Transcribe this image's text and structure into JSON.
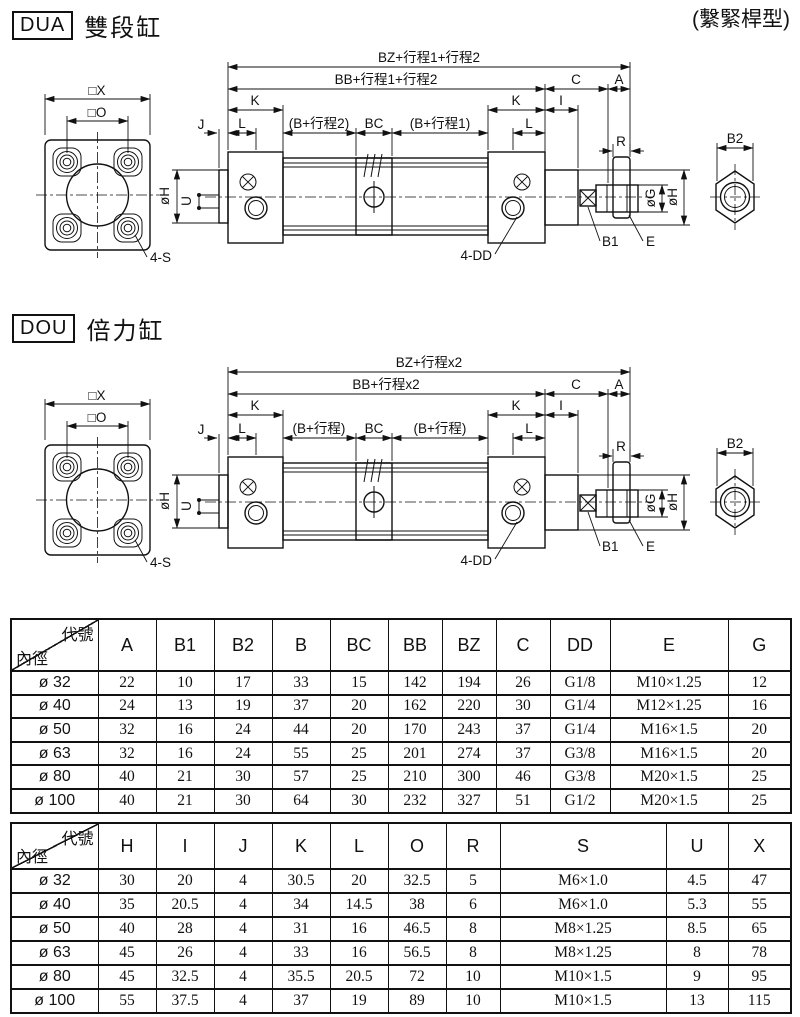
{
  "page": {
    "note": "(繫緊桿型)"
  },
  "sections": [
    {
      "code": "DUA",
      "title": "雙段缸",
      "dims": {
        "bz": "BZ+行程1+行程2",
        "bb": "BB+行程1+行程2",
        "c": "C",
        "a": "A",
        "k_left": "K",
        "k_right": "K",
        "i": "I",
        "j": "J",
        "l_left": "L",
        "l_right": "L",
        "b_stroke_left": "(B+行程2)",
        "bc": "BC",
        "b_stroke_right": "(B+行程1)",
        "r": "R",
        "b2": "B2",
        "og": "øG",
        "oh_right": "øH",
        "oh_left": "øH",
        "u": "U",
        "b1": "B1",
        "e": "E",
        "dd": "4-DD",
        "s": "4-S",
        "sq_x": "□X",
        "sq_o": "□O"
      }
    },
    {
      "code": "DOU",
      "title": "倍力缸",
      "dims": {
        "bz": "BZ+行程x2",
        "bb": "BB+行程x2",
        "c": "C",
        "a": "A",
        "k_left": "K",
        "k_right": "K",
        "i": "I",
        "j": "J",
        "l_left": "L",
        "l_right": "L",
        "b_stroke_left": "(B+行程)",
        "bc": "BC",
        "b_stroke_right": "(B+行程)",
        "r": "R",
        "b2": "B2",
        "og": "øG",
        "oh_right": "øH",
        "oh_left": "øH",
        "u": "U",
        "b1": "B1",
        "e": "E",
        "dd": "4-DD",
        "s": "4-S",
        "sq_x": "□X",
        "sq_o": "□O"
      }
    }
  ],
  "table1": {
    "corner": {
      "top": "代號",
      "bottom": "內徑"
    },
    "columns": [
      "A",
      "B1",
      "B2",
      "B",
      "BC",
      "BB",
      "BZ",
      "C",
      "DD",
      "E",
      "G"
    ],
    "rows": [
      {
        "bore": "ø 32",
        "values": [
          "22",
          "10",
          "17",
          "33",
          "15",
          "142",
          "194",
          "26",
          "G1/8",
          "M10×1.25",
          "12"
        ]
      },
      {
        "bore": "ø 40",
        "values": [
          "24",
          "13",
          "19",
          "37",
          "20",
          "162",
          "220",
          "30",
          "G1/4",
          "M12×1.25",
          "16"
        ]
      },
      {
        "bore": "ø 50",
        "values": [
          "32",
          "16",
          "24",
          "44",
          "20",
          "170",
          "243",
          "37",
          "G1/4",
          "M16×1.5",
          "20"
        ]
      },
      {
        "bore": "ø 63",
        "values": [
          "32",
          "16",
          "24",
          "55",
          "25",
          "201",
          "274",
          "37",
          "G3/8",
          "M16×1.5",
          "20"
        ]
      },
      {
        "bore": "ø 80",
        "values": [
          "40",
          "21",
          "30",
          "57",
          "25",
          "210",
          "300",
          "46",
          "G3/8",
          "M20×1.5",
          "25"
        ]
      },
      {
        "bore": "ø 100",
        "values": [
          "40",
          "21",
          "30",
          "64",
          "30",
          "232",
          "327",
          "51",
          "G1/2",
          "M20×1.5",
          "25"
        ]
      }
    ]
  },
  "table2": {
    "corner": {
      "top": "代號",
      "bottom": "內徑"
    },
    "columns": [
      "H",
      "I",
      "J",
      "K",
      "L",
      "O",
      "R",
      "S",
      "U",
      "X"
    ],
    "rows": [
      {
        "bore": "ø 32",
        "values": [
          "30",
          "20",
          "4",
          "30.5",
          "20",
          "32.5",
          "5",
          "M6×1.0",
          "4.5",
          "47"
        ]
      },
      {
        "bore": "ø 40",
        "values": [
          "35",
          "20.5",
          "4",
          "34",
          "14.5",
          "38",
          "6",
          "M6×1.0",
          "5.3",
          "55"
        ]
      },
      {
        "bore": "ø 50",
        "values": [
          "40",
          "28",
          "4",
          "31",
          "16",
          "46.5",
          "8",
          "M8×1.25",
          "8.5",
          "65"
        ]
      },
      {
        "bore": "ø 63",
        "values": [
          "45",
          "26",
          "4",
          "33",
          "16",
          "56.5",
          "8",
          "M8×1.25",
          "8",
          "78"
        ]
      },
      {
        "bore": "ø 80",
        "values": [
          "45",
          "32.5",
          "4",
          "35.5",
          "20.5",
          "72",
          "10",
          "M10×1.5",
          "9",
          "95"
        ]
      },
      {
        "bore": "ø 100",
        "values": [
          "55",
          "37.5",
          "4",
          "37",
          "19",
          "89",
          "10",
          "M10×1.5",
          "13",
          "115"
        ]
      }
    ]
  }
}
